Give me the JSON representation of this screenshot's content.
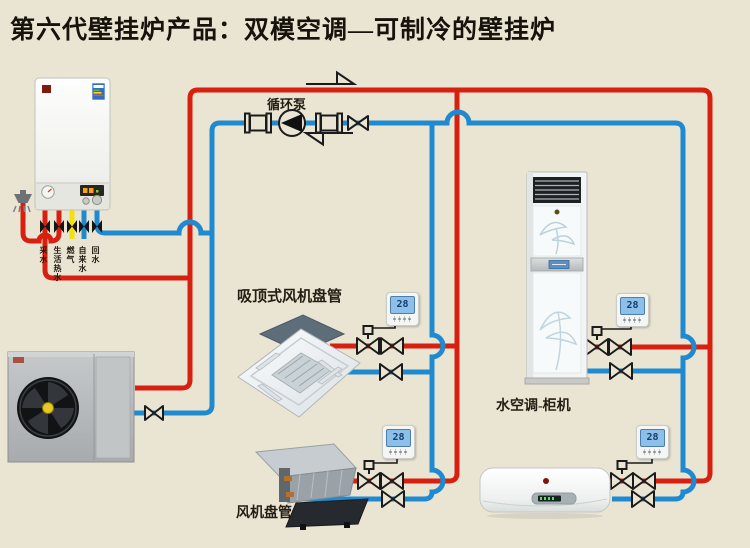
{
  "title": "第六代壁挂炉产品：双模空调—可制冷的壁挂炉",
  "labels": {
    "pump": "循环泵",
    "cassette": "吸顶式风机盘管",
    "cabinet": "水空调-柜机",
    "fan_coil": "风机盘管"
  },
  "boiler_ports": [
    {
      "label": "采水",
      "color": "#d7200f"
    },
    {
      "label": "生活热水",
      "color": "#d7200f"
    },
    {
      "label": "燃气",
      "color": "#f4e10a"
    },
    {
      "label": "自来水",
      "color": "#1f8ad0"
    },
    {
      "label": "回水",
      "color": "#1f8ad0"
    }
  ],
  "thermostats": [
    {
      "value": "28"
    },
    {
      "value": "28"
    },
    {
      "value": "28"
    },
    {
      "value": "28"
    }
  ],
  "colors": {
    "background": "#eae4d2",
    "pipe_hot": "#d7200f",
    "pipe_cold": "#1f8ad0",
    "pipe_gas": "#f4e10a",
    "line_black": "#1b1b1b",
    "thermostat_lcd": "#8cc0ea"
  },
  "icons": {
    "pump": "circle-with-left-triangle",
    "valve": "outline-bowtie",
    "motorized_valve": "bowtie-with-actuator-square",
    "flange": "square-with-side-plates",
    "flow_arrow_top": "right-arrow",
    "flow_arrow_bottom": "left-arrow",
    "shower": "shower-head-with-spray"
  }
}
